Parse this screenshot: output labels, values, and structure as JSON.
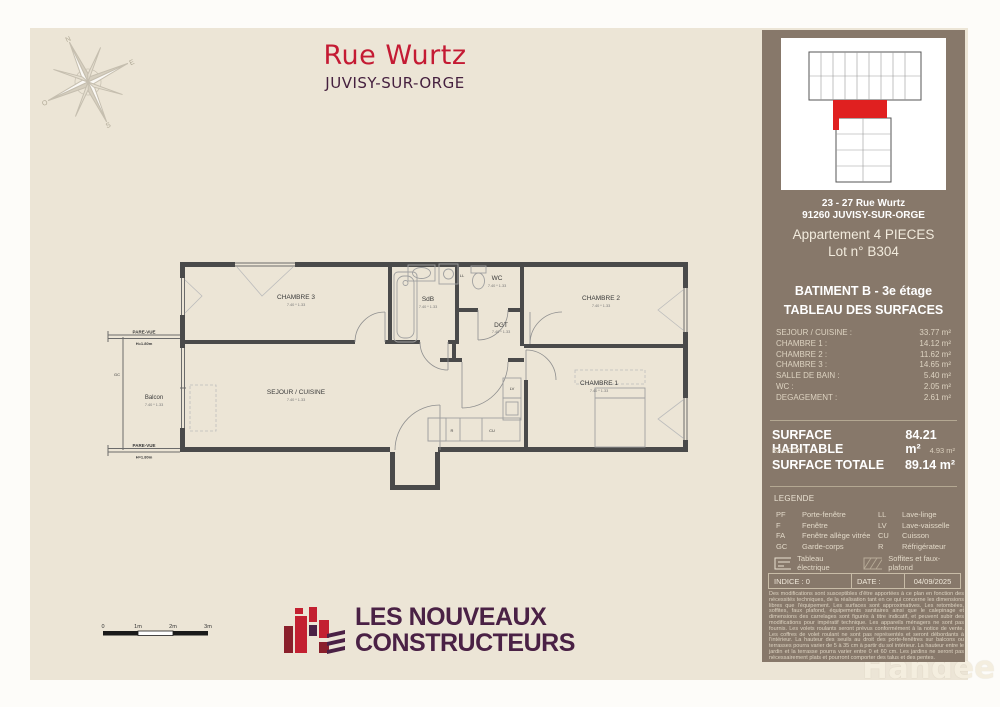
{
  "header": {
    "street": "Rue Wurtz",
    "city": "JUVISY-SUR-ORGE"
  },
  "colors": {
    "title_red": "#c41a33",
    "brand_purple": "#4a2145",
    "panel_brown": "#87786a",
    "page_beige": "#ece5d6",
    "keyplan_highlight_red": "#e02020"
  },
  "compass": {
    "n": "N",
    "s": "S",
    "e": "E",
    "o": "O"
  },
  "panel": {
    "address_line1": "23 - 27 Rue Wurtz",
    "address_line2": "91260 JUVISY-SUR-ORGE",
    "apartment": "Appartement 4 PIECES",
    "lot": "Lot n° B304",
    "building": "BATIMENT B - 3e étage",
    "table_title": "TABLEAU DES SURFACES",
    "surfaces": [
      {
        "label": "SEJOUR / CUISINE :",
        "value": "33.77 m²"
      },
      {
        "label": "CHAMBRE 1 :",
        "value": "14.12 m²"
      },
      {
        "label": "CHAMBRE 2 :",
        "value": "11.62 m²"
      },
      {
        "label": "CHAMBRE 3 :",
        "value": "14.65 m²"
      },
      {
        "label": "SALLE DE BAIN :",
        "value": "5.40 m²"
      },
      {
        "label": "WC :",
        "value": "2.05 m²"
      },
      {
        "label": "DEGAGEMENT :",
        "value": "2.61 m²"
      }
    ],
    "habitable": {
      "label": "SURFACE HABITABLE",
      "value": "84.21 m²"
    },
    "balcon": {
      "label": "BALCON :",
      "value": "4.93 m²"
    },
    "totale": {
      "label": "SURFACE TOTALE",
      "value": "89.14 m²"
    },
    "legend": {
      "title": "LEGENDE",
      "rows": [
        {
          "c1": "PF",
          "l1": "Porte-fenêtre",
          "c2": "LL",
          "l2": "Lave-linge"
        },
        {
          "c1": "F",
          "l1": "Fenêtre",
          "c2": "LV",
          "l2": "Lave-vaisselle"
        },
        {
          "c1": "FA",
          "l1": "Fenêtre allège vitrée",
          "c2": "CU",
          "l2": "Cuisson"
        },
        {
          "c1": "GC",
          "l1": "Garde-corps",
          "c2": "R",
          "l2": "Réfrigérateur"
        }
      ],
      "electric_label": "Tableau électrique",
      "soffites_label": "Soffites et faux-plafond"
    },
    "footer": {
      "indice_label": "INDICE :",
      "indice_value": "0",
      "date_label": "DATE :",
      "date_value": "04/09/2025"
    },
    "disclaimer": "Des modifications sont susceptibles d'être apportées à ce plan en fonction des nécessités techniques, de la réalisation tant en ce qui concerne les dimensions libres que l'équipement. Les surfaces sont approximatives. Les retombées, soffites, faux plafond, équipements sanitaires ainsi que le calepinage et dimensions des carrelages sont figurés à titre indicatif, et peuvent subir des modifications pour impératif technique. Les appareils ménagers ne sont pas fournis. Les volets roulants seront prévus conformément à la notice de vente. Les coffres de volet roulant ne sont pas représentés et seront débordants à l'intérieur. La hauteur des seuils au droit des porte-fenêtres sur balcons ou terrasses pourra varier de 5 à 35 cm à partir du sol intérieur. La hauteur entre le jardin et la terrasse pourra varier entre 0 et 60 cm. Les jardins ne seront pas nécessairement plats et pourront comporter des talus et des pentes."
  },
  "plan": {
    "rooms": [
      {
        "name": "CHAMBRE 3",
        "dims": "7.40 * 1.33"
      },
      {
        "name": "SdB",
        "dims": "7.40 * 1.33"
      },
      {
        "name": "WC",
        "dims": "7.40 * 1.33"
      },
      {
        "name": "CHAMBRE 2",
        "dims": "7.40 * 1.33"
      },
      {
        "name": "DGT",
        "dims": "7.40 * 1.33"
      },
      {
        "name": "SEJOUR / CUISINE",
        "dims": "7.40 * 1.33"
      },
      {
        "name": "CHAMBRE 1",
        "dims": "7.40 * 1.33"
      },
      {
        "name": "Balcon",
        "dims": "7.40 * 1.33"
      }
    ],
    "annotations": {
      "pare_vue": "PARE-VUE",
      "pare_vue_h": "H=1.80m",
      "gc": "GC",
      "ll": "LL",
      "lv": "LV",
      "cu": "CU",
      "r": "R"
    }
  },
  "scalebar": {
    "labels": [
      "0",
      "1m",
      "2m",
      "3m"
    ]
  },
  "logo": {
    "line1": "LES NOUVEAUX",
    "line2": "CONSTRUCTEURS"
  },
  "watermark": "Handee"
}
